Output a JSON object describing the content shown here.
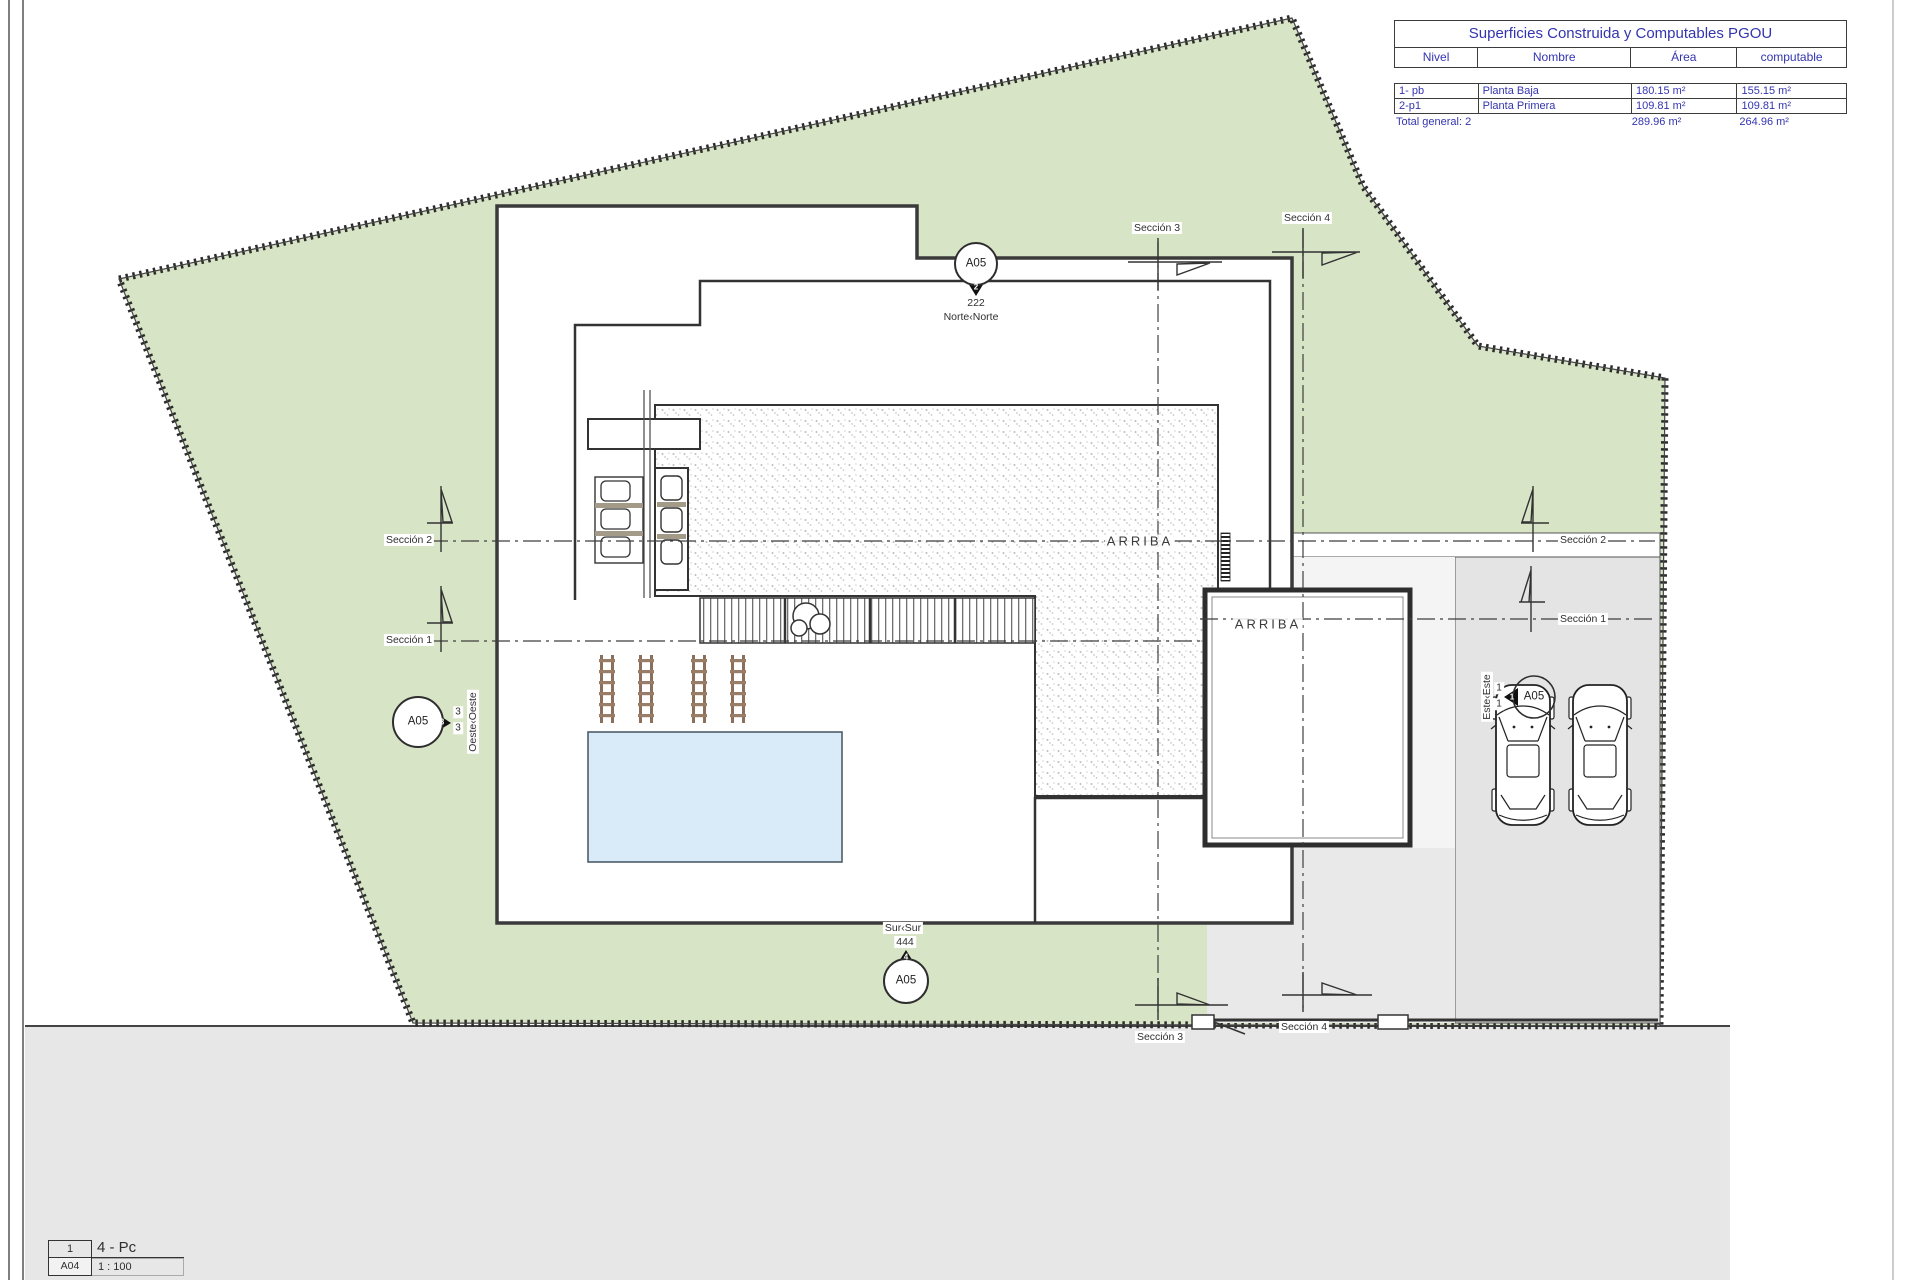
{
  "summary_table": {
    "title": "Superficies Construida y Computables PGOU",
    "headers": [
      "Nivel",
      "Nombre",
      "Área",
      "computable"
    ],
    "rows": [
      {
        "nivel": "1- pb",
        "nombre": "Planta Baja",
        "area": "180.15 m²",
        "computable": "155.15 m²"
      },
      {
        "nivel": "2-p1",
        "nombre": "Planta Primera",
        "area": "109.81 m²",
        "computable": "109.81 m²"
      }
    ],
    "total": {
      "label": "Total general: 2",
      "area": "289.96 m²",
      "computable": "264.96 m²"
    }
  },
  "section_labels": {
    "s1": "Sección 1",
    "s2": "Sección 2",
    "s3": "Sección 3",
    "s4": "Sección 4"
  },
  "plan_labels": {
    "arriba": "ARRIBA"
  },
  "callouts": {
    "north": {
      "sheet": "A05",
      "badge": "2",
      "dim": "222",
      "label": "Norte‹Norte"
    },
    "south": {
      "sheet": "A05",
      "badge": "4",
      "dim": "444",
      "label": "Sur‹Sur"
    },
    "west": {
      "sheet": "A05",
      "badge": "3",
      "stack1": "3",
      "stack2": "3",
      "label": "Oeste‹Oeste"
    },
    "east": {
      "sheet": "A05",
      "badge": "1",
      "stack1": "1",
      "stack2": "1",
      "label": "Este‹Este"
    }
  },
  "title_block": {
    "view_number": "1",
    "sheet_ref": "A04",
    "view_name": "4 - Pc",
    "scale": "1 : 100"
  },
  "colors": {
    "garden": "#d8e4c6",
    "paving": "#e4e4e4",
    "pool": "#d9ebf8",
    "table_text": "#3434b0"
  }
}
